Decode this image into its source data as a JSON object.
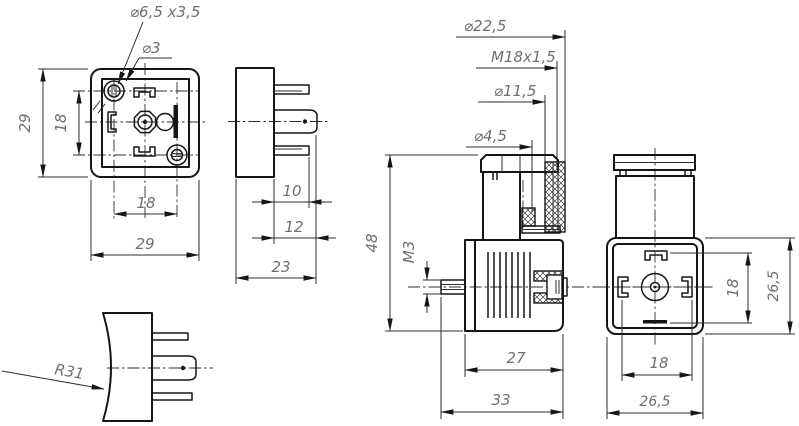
{
  "colors": {
    "background": "#ffffff",
    "line": "#161616",
    "dim_text": "#6f6f6f"
  },
  "dims": {
    "fl_cbore": "⌀6,5 x3,5",
    "fl_hole": "⌀3",
    "fl_h_outer": "29",
    "fl_h_inner": "18",
    "fl_w_inner": "18",
    "fl_w_outer": "29",
    "sv_pin_short": "10",
    "sv_pin_center": "12",
    "sv_total": "23",
    "rv_radius": "R31",
    "ld_gland": "⌀22,5",
    "ld_thread": "M18x1,5",
    "ld_bore": "⌀11,5",
    "ld_screw": "⌀4,5",
    "sec_height": "48",
    "sec_thread": "M3",
    "sec_body_w": "27",
    "sec_total_w": "33",
    "pf_v_inner": "18",
    "pf_v_outer": "26,5",
    "pf_w_inner": "18",
    "pf_w_outer": "26,5"
  }
}
